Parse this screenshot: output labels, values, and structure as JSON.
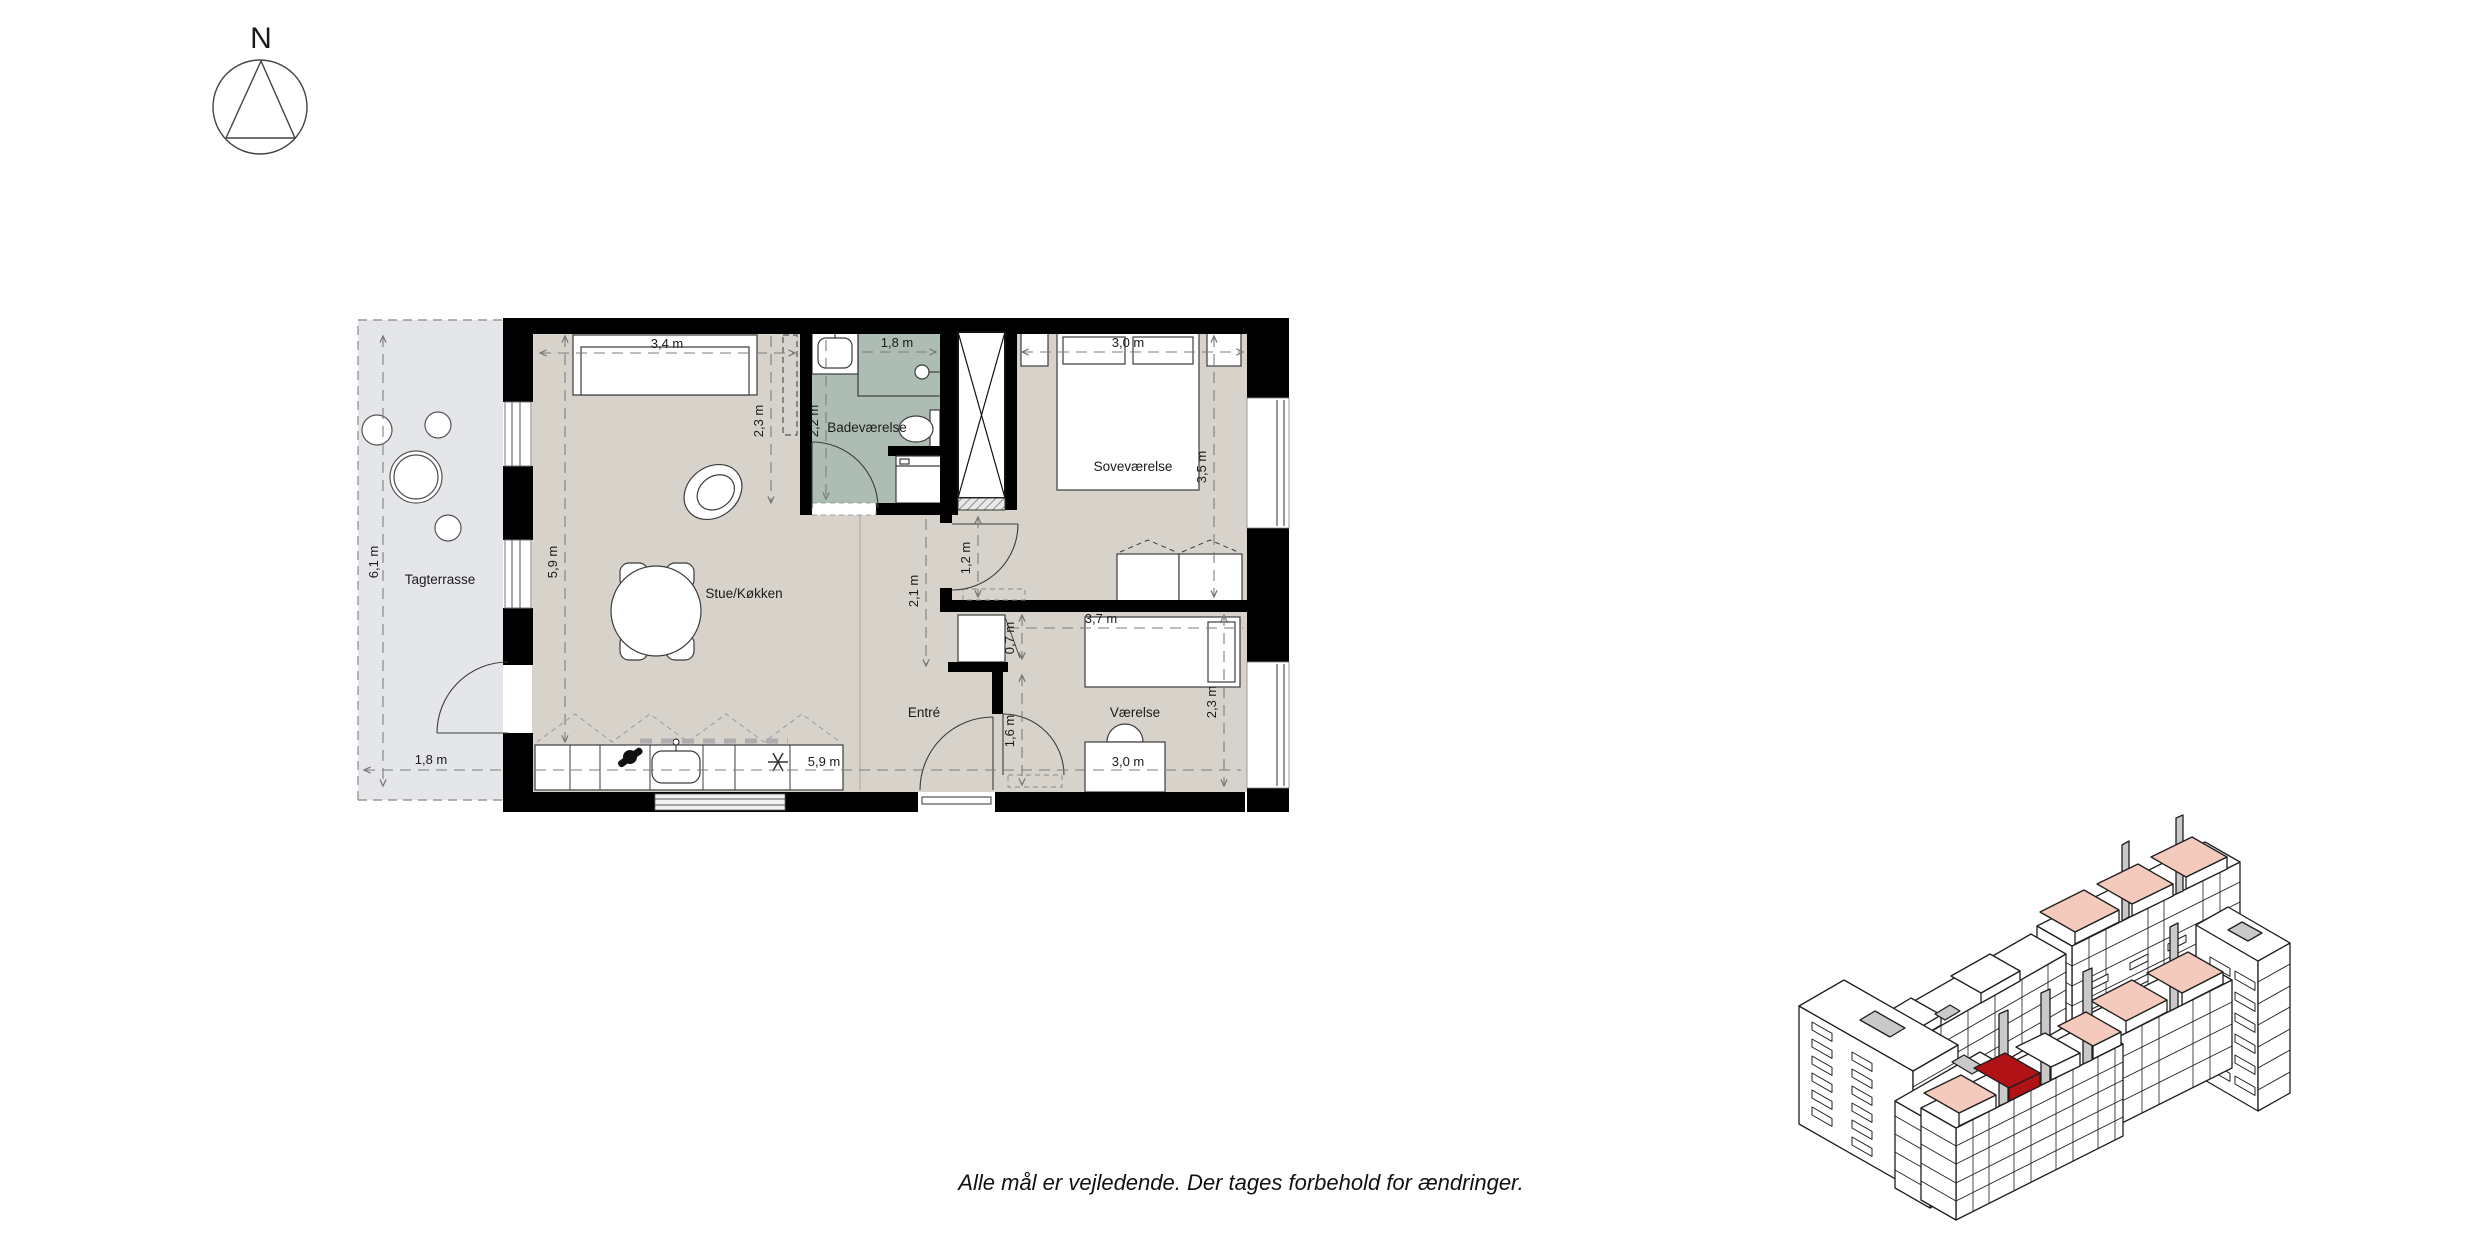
{
  "compass": {
    "north_label": "N"
  },
  "floor_plan": {
    "rooms": {
      "terrace": "Tagterrasse",
      "living": "Stue/Køkken",
      "bathroom": "Badeværelse",
      "bedroom": "Soveværelse",
      "hall": "Entré",
      "room": "Værelse"
    },
    "dimensions": {
      "terrace_length": "6,1 m",
      "terrace_width": "1,8 m",
      "sofa_wall": "3,4 m",
      "living_length": "5,9 m",
      "living_niche": "2,3 m",
      "bathroom_width": "2,2 m",
      "shower_width": "1,8 m",
      "bedroom_bed": "3,0 m",
      "bedroom_depth": "3,5 m",
      "bedroom_door": "1,2 m",
      "hall_width": "2,1 m",
      "kitchen_length": "5,9 m",
      "room_bed": "3,7 m",
      "room_niche": "0,7 m",
      "room_door": "1,6 m",
      "room_depth": "2,3 m",
      "room_desk": "3,0 m"
    },
    "colors": {
      "floor": "#d8d3ca",
      "terrace": "#e4e6e9",
      "bathroom": "#adbdb4",
      "wall": "#000000"
    }
  },
  "site_plan": {
    "unit_highlight": "#b11215",
    "penthouse_highlight": "#f3cabb",
    "core_gray": "#c9c9c9"
  },
  "footer": {
    "disclaimer": "Alle mål er vejledende. Der tages forbehold for ændringer."
  }
}
